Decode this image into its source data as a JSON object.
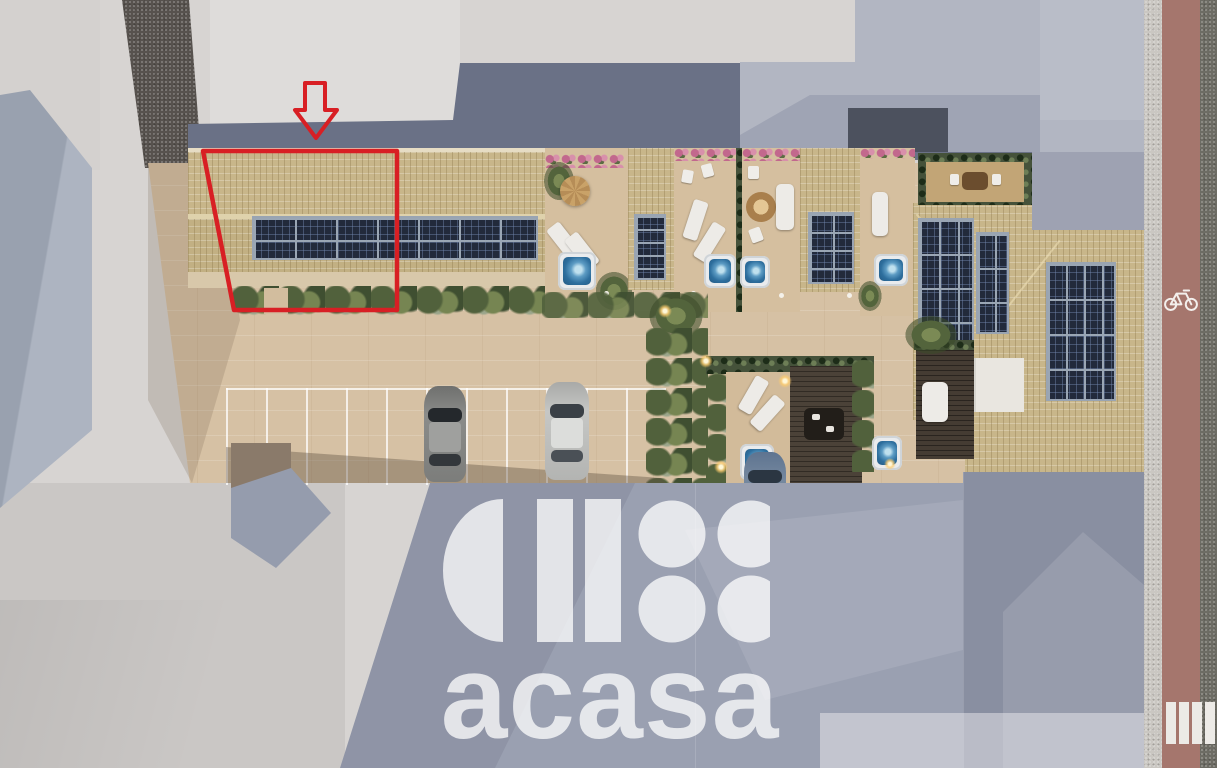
{
  "scene": {
    "kind": "aerial-3d-site-plan-render",
    "canvas": {
      "width": 1217,
      "height": 768
    }
  },
  "watermark": {
    "brand_text": "acasa",
    "color": "#ffffff",
    "opacity": 0.75,
    "logo_icon": "acasa-logo-mark",
    "logo_shapes": [
      "left-half-disc",
      "vertical-bar",
      "vertical-bar",
      "dot-grid-2x2"
    ]
  },
  "annotation": {
    "highlight_color": "#d81f24",
    "outline_shape": "highlighted-unit-polygon",
    "arrow_icon": "down-arrow-icon"
  },
  "palette": {
    "ground_light": "#d7d4d2",
    "ground_southwest": "#cac7c5",
    "courtyard_tan": "#d6c1a4",
    "roof_tile_tan": "#c8b68a",
    "terrace_floor": "#d5bf9f",
    "solar_panel_navy": "#222a3b",
    "north_shadow_slate": "#6a7186",
    "south_shadow_blue_gray": "#9aa0b1",
    "neighbor_building_gray": "#b2b6c2",
    "neighbor_building_west": "#a3aab8",
    "road_dark": "#57524e",
    "bike_lane_pink": "#a5766d",
    "sidewalk_gray": "#cac7c2",
    "dark_edge_strip": "#6d6c64",
    "garden_green": "#4f5f3c",
    "hot_tub_water": "#4f8cb8",
    "parking_line_white": "#f2ebe0",
    "crosswalk_white": "#eceae6"
  },
  "features": {
    "parking_spaces": 11,
    "cars": 3,
    "solar_arrays": 6,
    "hot_tubs": 6,
    "roof_terraces": 5,
    "crosswalk_stripes": 4,
    "bike_lane_icon": "bicycle-icon"
  }
}
